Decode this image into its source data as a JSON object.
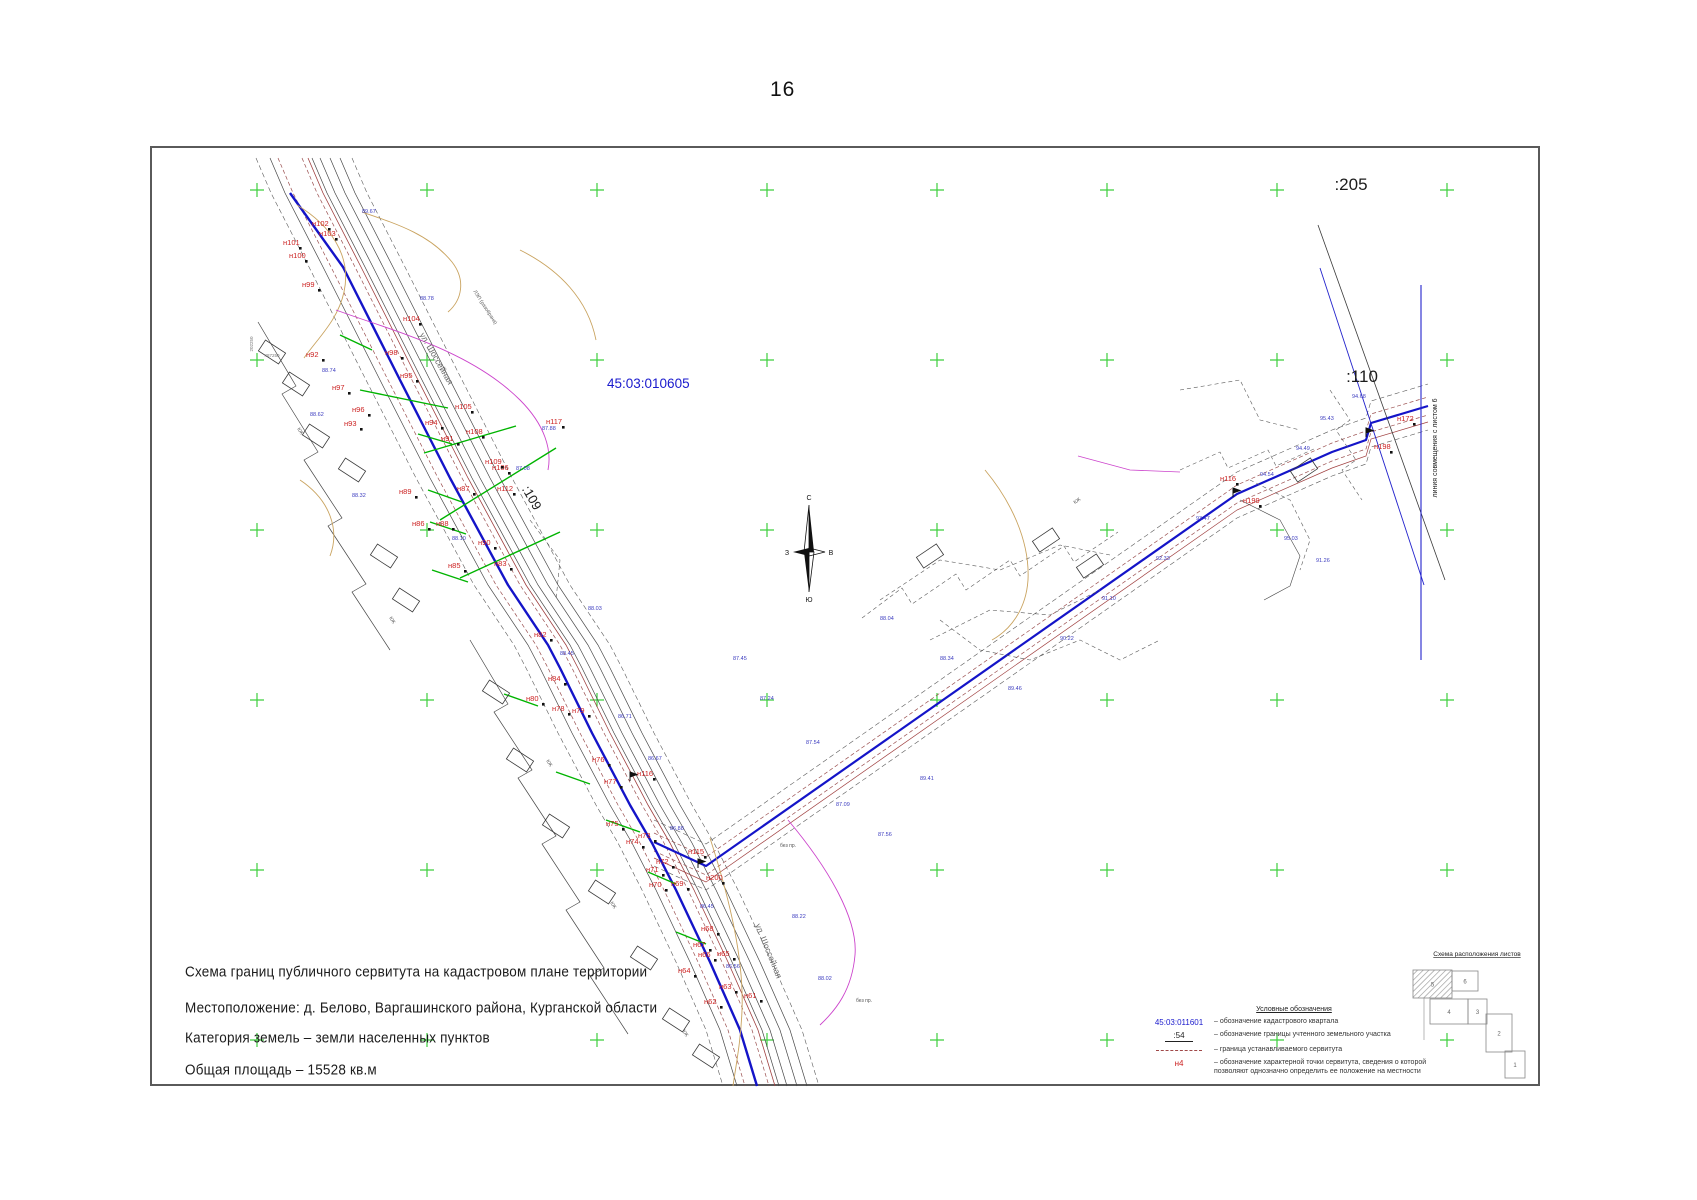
{
  "page_number": "16",
  "title_block": {
    "lines": [
      "Схема границ публичного сервитута на кадастровом плане территории",
      "Местоположение:  д. Белово, Варгашинского района, Курганской области",
      "Категория земель – земли населенных пунктов",
      "Общая площадь – 15528 кв.м"
    ]
  },
  "legend": {
    "title": "Условные обозначения",
    "items": [
      {
        "symbol": "45:03:011601",
        "type": "quarter",
        "text": "– обозначение кадастрового квартала"
      },
      {
        "symbol": ":54",
        "type": "parcel",
        "text": "– обозначение границы учтенного земельного участка"
      },
      {
        "symbol": "",
        "type": "dash",
        "text": "– граница устанавливаемого сервитута"
      },
      {
        "symbol": "н4",
        "type": "point",
        "text": "– обозначение характерной точки сервитута, сведения о которой позволяют однозначно определить ее положение на местности"
      }
    ]
  },
  "sheet_scheme": {
    "title": "Схема расположения листов",
    "sheets": [
      {
        "label": "5",
        "current": true,
        "x": 1413,
        "y": 970,
        "w": 39,
        "h": 28
      },
      {
        "label": "6",
        "current": false,
        "x": 1452,
        "y": 971,
        "w": 26,
        "h": 20
      },
      {
        "label": "4",
        "current": false,
        "x": 1430,
        "y": 999,
        "w": 38,
        "h": 25
      },
      {
        "label": "3",
        "current": false,
        "x": 1468,
        "y": 999,
        "w": 19,
        "h": 25
      },
      {
        "label": "2",
        "current": false,
        "x": 1486,
        "y": 1014,
        "w": 26,
        "h": 38
      },
      {
        "label": "1",
        "current": false,
        "x": 1505,
        "y": 1051,
        "w": 20,
        "h": 27
      }
    ]
  },
  "map": {
    "quarter_label": {
      "t": "45:03:010605",
      "x": 607,
      "y": 388,
      "size": 13.5,
      "color": "#1a1acd"
    },
    "parcel_labels": [
      {
        "t": ":205",
        "x": 1351,
        "y": 190,
        "size": 17,
        "rot": 0
      },
      {
        "t": ":110",
        "x": 1362,
        "y": 382,
        "size": 17,
        "rot": 0
      },
      {
        "t": ":109",
        "x": 528,
        "y": 500,
        "size": 13,
        "rot": 60
      }
    ],
    "alignment_label": {
      "t": "линия совмещения с листом 6",
      "x": 1437,
      "y": 448,
      "size": 7,
      "rot": -90
    },
    "street_labels": [
      {
        "t": "ул. Шоссейная",
        "x": 434,
        "y": 360,
        "rot": 60,
        "size": 8.5
      },
      {
        "t": "ул. Шоссейная",
        "x": 766,
        "y": 952,
        "rot": 68,
        "size": 8.5
      }
    ],
    "misc_labels": [
      {
        "t": "ЛЭП (разобрана)",
        "x": 484,
        "y": 308,
        "rot": 57,
        "size": 5,
        "color": "#555"
      },
      {
        "t": "КЖ",
        "x": 299,
        "y": 432,
        "rot": 57,
        "size": 5,
        "color": "#555"
      },
      {
        "t": "КЖ",
        "x": 391,
        "y": 621,
        "rot": 57,
        "size": 5,
        "color": "#555"
      },
      {
        "t": "КЖ",
        "x": 548,
        "y": 764,
        "rot": 57,
        "size": 5,
        "color": "#555"
      },
      {
        "t": "КЖ",
        "x": 612,
        "y": 906,
        "rot": 57,
        "size": 5,
        "color": "#555"
      },
      {
        "t": "КЖ",
        "x": 684,
        "y": 1034,
        "rot": 57,
        "size": 5,
        "color": "#555"
      },
      {
        "t": "КЖ",
        "x": 1078,
        "y": 502,
        "rot": -34,
        "size": 5,
        "color": "#555"
      },
      {
        "t": "без пр.",
        "x": 788,
        "y": 847,
        "rot": 0,
        "size": 5,
        "color": "#555"
      },
      {
        "t": "без пр.",
        "x": 864,
        "y": 1002,
        "rot": 0,
        "size": 5,
        "color": "#555"
      },
      {
        "t": "487250",
        "x": 272,
        "y": 357,
        "rot": 0,
        "size": 4.5,
        "color": "#777"
      },
      {
        "t": "202250",
        "x": 253,
        "y": 344,
        "rot": -90,
        "size": 4.5,
        "color": "#777"
      }
    ],
    "point_labels": [
      [
        "н102",
        312,
        226
      ],
      [
        "н103",
        319,
        236
      ],
      [
        "н101",
        283,
        245
      ],
      [
        "н100",
        289,
        258
      ],
      [
        "н99",
        302,
        287
      ],
      [
        "н92",
        306,
        357
      ],
      [
        "н97",
        332,
        390
      ],
      [
        "н96",
        352,
        412
      ],
      [
        "н93",
        344,
        426
      ],
      [
        "н98",
        385,
        355
      ],
      [
        "н95",
        400,
        378
      ],
      [
        "н104",
        403,
        321
      ],
      [
        "н94",
        425,
        425
      ],
      [
        "н91",
        441,
        441
      ],
      [
        "н105",
        455,
        409
      ],
      [
        "н106",
        492,
        470
      ],
      [
        "н108",
        466,
        434
      ],
      [
        "н109",
        485,
        464
      ],
      [
        "н112",
        497,
        491
      ],
      [
        "н117",
        546,
        424
      ],
      [
        "н87",
        457,
        491
      ],
      [
        "н86",
        412,
        526
      ],
      [
        "н89",
        399,
        494
      ],
      [
        "н88",
        436,
        526
      ],
      [
        "н90",
        478,
        545
      ],
      [
        "н85",
        448,
        568
      ],
      [
        "н83",
        494,
        566
      ],
      [
        "н82",
        534,
        637
      ],
      [
        "н84",
        548,
        681
      ],
      [
        "н80",
        526,
        701
      ],
      [
        "н78",
        552,
        711
      ],
      [
        "н79",
        572,
        713
      ],
      [
        "н77",
        604,
        784
      ],
      [
        "н76",
        592,
        762
      ],
      [
        "н116",
        637,
        776
      ],
      [
        "н75",
        606,
        826
      ],
      [
        "н73",
        638,
        838
      ],
      [
        "н74",
        626,
        844
      ],
      [
        "н72",
        656,
        864
      ],
      [
        "н71",
        646,
        872
      ],
      [
        "н70",
        649,
        887
      ],
      [
        "н69",
        671,
        886
      ],
      [
        "н115",
        688,
        854
      ],
      [
        "н200",
        706,
        880
      ],
      [
        "н68",
        701,
        931
      ],
      [
        "н67",
        693,
        947
      ],
      [
        "н66",
        698,
        957
      ],
      [
        "н65",
        717,
        956
      ],
      [
        "н64",
        678,
        973
      ],
      [
        "н63",
        719,
        989
      ],
      [
        "н62",
        704,
        1004
      ],
      [
        "н61",
        744,
        998
      ],
      [
        "н116",
        1220,
        481
      ],
      [
        "н199",
        1243,
        503
      ],
      [
        "н198",
        1374,
        449
      ],
      [
        "н172",
        1397,
        421
      ]
    ],
    "elevation_labels": [
      [
        362,
        213,
        "89.67"
      ],
      [
        322,
        372,
        "88.74"
      ],
      [
        420,
        300,
        "88.78"
      ],
      [
        310,
        416,
        "88.62"
      ],
      [
        352,
        497,
        "88.32"
      ],
      [
        452,
        540,
        "88.10"
      ],
      [
        516,
        470,
        "87.08"
      ],
      [
        542,
        430,
        "87.88"
      ],
      [
        588,
        610,
        "88.03"
      ],
      [
        560,
        655,
        "88.45"
      ],
      [
        618,
        718,
        "86.71"
      ],
      [
        648,
        760,
        "86.67"
      ],
      [
        670,
        830,
        "86.88"
      ],
      [
        700,
        908,
        "86.45"
      ],
      [
        726,
        968,
        "86.56"
      ],
      [
        836,
        806,
        "87.09"
      ],
      [
        878,
        836,
        "87.56"
      ],
      [
        920,
        780,
        "89.41"
      ],
      [
        1008,
        690,
        "89.46"
      ],
      [
        1060,
        640,
        "90.22"
      ],
      [
        1102,
        600,
        "91.10"
      ],
      [
        1156,
        560,
        "92.33"
      ],
      [
        1196,
        520,
        "93.47"
      ],
      [
        1260,
        476,
        "94.54"
      ],
      [
        1296,
        450,
        "94.49"
      ],
      [
        1320,
        420,
        "95.43"
      ],
      [
        1352,
        398,
        "94.68"
      ],
      [
        1284,
        540,
        "95.03"
      ],
      [
        1316,
        562,
        "91.26"
      ],
      [
        880,
        620,
        "88.04"
      ],
      [
        940,
        660,
        "88.34"
      ],
      [
        806,
        744,
        "87.54"
      ],
      [
        760,
        700,
        "87.24"
      ],
      [
        733,
        660,
        "87.45"
      ],
      [
        818,
        980,
        "88.02"
      ],
      [
        792,
        918,
        "88.22"
      ]
    ],
    "compass": {
      "cx": 809,
      "cy": 552,
      "n": "С",
      "s": "Ю",
      "w": "З",
      "e": "В"
    },
    "crosses": {
      "xs": [
        257,
        427,
        597,
        767,
        937,
        1107,
        1277,
        1447
      ],
      "ys": [
        190,
        360,
        530,
        700,
        870,
        1040
      ],
      "color": "#3ecf3e"
    },
    "corridors": {
      "left": {
        "points": [
          [
            290,
            158
          ],
          [
            305,
            193
          ],
          [
            343,
            267
          ],
          [
            400,
            380
          ],
          [
            450,
            478
          ],
          [
            508,
            585
          ],
          [
            548,
            645
          ],
          [
            560,
            668
          ],
          [
            592,
            733
          ],
          [
            630,
            805
          ],
          [
            652,
            843
          ],
          [
            676,
            890
          ],
          [
            710,
            962
          ],
          [
            740,
            1030
          ],
          [
            757,
            1086
          ]
        ],
        "offsets": [
          {
            "dx": -12,
            "s": "#9a4f4f",
            "w": 0.7,
            "dash": "4 2.5"
          },
          {
            "dx": 12,
            "s": "#9a4f4f",
            "w": 0.7,
            "dash": "4 2.5"
          },
          {
            "dx": 18,
            "s": "#a04040",
            "w": 0.8
          },
          {
            "dx": -20,
            "s": "#474747",
            "w": 0.7
          },
          {
            "dx": 22,
            "s": "#474747",
            "w": 0.7
          },
          {
            "dx": 30,
            "s": "#474747",
            "w": 0.7
          },
          {
            "dx": 40,
            "s": "#474747",
            "w": 0.7
          },
          {
            "dx": 50,
            "s": "#474747",
            "w": 0.7
          },
          {
            "dx": 62,
            "s": "#5a5a5a",
            "w": 0.6,
            "dash": "5 3"
          },
          {
            "dx": -34,
            "s": "#5a5a5a",
            "w": 0.6,
            "dash": "5 3"
          }
        ]
      },
      "right": {
        "points": [
          [
            654,
            842
          ],
          [
            706,
            866
          ],
          [
            1237,
            494
          ],
          [
            1332,
            452
          ],
          [
            1366,
            440
          ],
          [
            1371,
            423
          ],
          [
            1428,
            406
          ]
        ],
        "offsets": [
          {
            "dy": -9,
            "s": "#9a4f4f",
            "w": 0.7,
            "dash": "4 2.5"
          },
          {
            "dy": 9,
            "s": "#9a4f4f",
            "w": 0.7,
            "dash": "4 2.5"
          },
          {
            "dy": 16,
            "s": "#a04040",
            "w": 0.7
          },
          {
            "dy": -22,
            "s": "#5a5a5a",
            "w": 0.6,
            "dash": "5 3"
          },
          {
            "dy": 24,
            "s": "#5a5a5a",
            "w": 0.6,
            "dash": "5 3"
          }
        ]
      }
    },
    "paths": [
      {
        "d": "M290,193 L343,267 L400,380 L450,478 L508,585 L548,645 L560,668 L592,733 L630,805 L652,843 L676,890 L710,962 L740,1030 L757,1086",
        "s": "#1414c8",
        "w": 2.4
      },
      {
        "d": "M654,842 L706,866 L1237,494 L1332,452 L1366,440 L1371,423 L1428,406",
        "s": "#1414c8",
        "w": 2.2
      },
      {
        "d": "M1318,225 L1445,580",
        "s": "#3a3a3a",
        "w": 0.8
      },
      {
        "d": "M1320,268 L1424,585",
        "s": "#2323cc",
        "w": 0.9
      },
      {
        "d": "M1421,285 L1421,660",
        "s": "#2323cc",
        "w": 1.1
      },
      {
        "d": "M258,322 L296,386 L282,394 L318,452 L304,460 L342,518 L328,526 L366,584 L352,592 L390,650",
        "s": "#474747",
        "w": 0.7
      },
      {
        "d": "M470,640 L508,704 L494,712 L532,770 L518,778 L556,836 L542,844 L580,902 L566,910 L604,968 L590,976 L628,1034",
        "s": "#474747",
        "w": 0.7
      },
      {
        "d": "M862,618 L902,588 L912,604 L956,574 L966,590 L1010,560 L1020,576 L1064,546 L1074,562 L1118,532",
        "s": "#5a5a5a",
        "w": 0.6,
        "dash": "4 3"
      },
      {
        "d": "M1180,470 L1220,452 L1228,468 L1268,450 L1276,466 L1316,448",
        "s": "#5a5a5a",
        "w": 0.6,
        "dash": "4 3"
      },
      {
        "d": "M1330,390 L1350,420 L1336,430 L1356,460 L1342,470 L1362,500",
        "s": "#5a5a5a",
        "w": 0.6,
        "dash": "4 3"
      },
      {
        "d": "M940,620 L980,650 L1030,660 L1080,640 L1120,660 L1160,640",
        "s": "#5a5a5a",
        "w": 0.6,
        "dash": "4 3"
      },
      {
        "d": "M1240,500 L1280,520 L1300,556 L1290,586 L1264,600",
        "s": "#474747",
        "w": 0.6
      },
      {
        "d": "M880,600 L940,560 L1000,570 L1060,545 L1110,555",
        "s": "#5a5a5a",
        "w": 0.6,
        "dash": "4 3"
      },
      {
        "d": "M930,640 L990,610 L1050,615 L1100,590",
        "s": "#5a5a5a",
        "w": 0.6,
        "dash": "4 3"
      },
      {
        "d": "M1180,390 L1240,380 L1260,420 L1300,430",
        "s": "#5a5a5a",
        "w": 0.6,
        "dash": "4 3"
      },
      {
        "d": "M1250,480 L1290,500 L1310,540 L1300,570",
        "s": "#5a5a5a",
        "w": 0.6,
        "dash": "4 3"
      },
      {
        "d": "M530,520 L560,560 L556,600",
        "s": "#5a5a5a",
        "w": 0.6,
        "dash": "4 3"
      },
      {
        "d": "M297,205 C330,225 352,255 344,292 C338,320 318,338 304,358",
        "s": "#c9a35f",
        "w": 0.9
      },
      {
        "d": "M362,212 C400,225 430,235 452,262 C466,280 462,300 448,312",
        "s": "#c9a35f",
        "w": 0.9
      },
      {
        "d": "M520,250 C560,270 588,300 596,340",
        "s": "#c9a35f",
        "w": 0.9
      },
      {
        "d": "M710,838 C730,900 744,960 742,1010 C741,1040 736,1065 733,1086",
        "s": "#c9a35f",
        "w": 0.9
      },
      {
        "d": "M985,470 C1010,500 1030,540 1028,580 C1026,610 1010,630 992,640",
        "s": "#c9a35f",
        "w": 0.9
      },
      {
        "d": "M300,480 C330,500 340,530 330,556",
        "s": "#c9a35f",
        "w": 0.9
      },
      {
        "d": "M336,310 C390,330 470,350 520,400 C545,425 552,450 548,470",
        "s": "#cc44cc",
        "w": 0.9
      },
      {
        "d": "M788,820 C830,870 858,920 855,955 C852,990 836,1010 820,1025",
        "s": "#cc44cc",
        "w": 0.9
      },
      {
        "d": "M1078,456 L1130,470 L1180,472",
        "s": "#cc44cc",
        "w": 0.8
      },
      {
        "d": "M1424,998 L1424,1040",
        "s": "#888888",
        "w": 0.6
      }
    ],
    "green_segments": [
      [
        340,
        335,
        372,
        350
      ],
      [
        360,
        390,
        448,
        408
      ],
      [
        418,
        434,
        452,
        444
      ],
      [
        428,
        490,
        462,
        502
      ],
      [
        430,
        522,
        466,
        534
      ],
      [
        432,
        570,
        468,
        582
      ],
      [
        504,
        694,
        538,
        706
      ],
      [
        556,
        772,
        590,
        784
      ],
      [
        606,
        820,
        640,
        832
      ],
      [
        648,
        872,
        676,
        884
      ],
      [
        676,
        932,
        706,
        944
      ],
      [
        440,
        520,
        556,
        448
      ],
      [
        460,
        578,
        560,
        532
      ],
      [
        424,
        453,
        516,
        426
      ]
    ],
    "buildings": [
      [
        272,
        352,
        33
      ],
      [
        296,
        384,
        33
      ],
      [
        316,
        436,
        33
      ],
      [
        352,
        470,
        33
      ],
      [
        384,
        556,
        33
      ],
      [
        406,
        600,
        33
      ],
      [
        496,
        692,
        33
      ],
      [
        520,
        760,
        33
      ],
      [
        556,
        826,
        33
      ],
      [
        602,
        892,
        33
      ],
      [
        644,
        958,
        33
      ],
      [
        676,
        1020,
        33
      ],
      [
        706,
        1056,
        33
      ],
      [
        1046,
        540,
        -34
      ],
      [
        1090,
        566,
        -34
      ],
      [
        930,
        556,
        -34
      ],
      [
        1304,
        470,
        -34
      ]
    ],
    "flags": [
      [
        698,
        868
      ],
      [
        1233,
        497
      ],
      [
        630,
        781
      ],
      [
        1366,
        437
      ]
    ]
  }
}
